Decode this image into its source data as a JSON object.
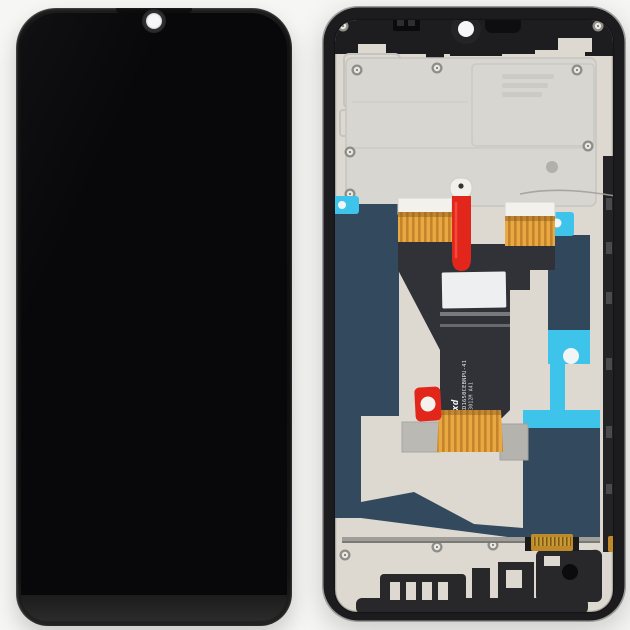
{
  "sticker_text": {
    "brand": "Txd",
    "part_number": "TXD1650CEBNPU-41",
    "batch_code": "JB3012M A41"
  },
  "colors": {
    "background": "#f6f6f4",
    "front_body": "#121213",
    "front_screen": "#08080a",
    "camera_dot": "#f7f7f7",
    "frame_black": "#1c1c1e",
    "plate_beige": "#ddd9d1",
    "shield_gray": "#d8d6d1",
    "flex_black": "#303237",
    "ribbon_gold": "#e2a23c",
    "pull_tab_red": "#e3261b",
    "sticker_cyan": "#3ec4ea",
    "panel_navy": "#33495d",
    "label_white": "#edeff0",
    "connector_gold": "#c08a2a",
    "bracket_gray": "#bbb9b4",
    "molding_black": "#28282b",
    "rail_silver": "#c6c4bf"
  }
}
